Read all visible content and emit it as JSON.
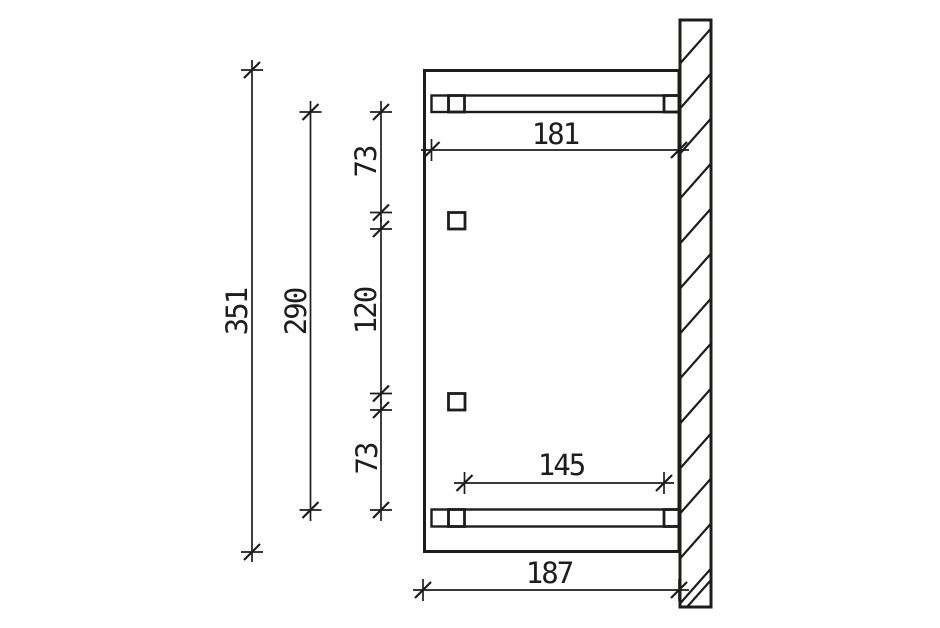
{
  "colors": {
    "line": "#1d1d1b",
    "background": "#ffffff"
  },
  "dims": {
    "total_height": "351",
    "frame_height": "290",
    "top_spacing": "73",
    "middle_spacing": "120",
    "bottom_spacing": "73",
    "top_beam_length": "181",
    "bottom_beam_span": "145",
    "total_depth": "187"
  }
}
